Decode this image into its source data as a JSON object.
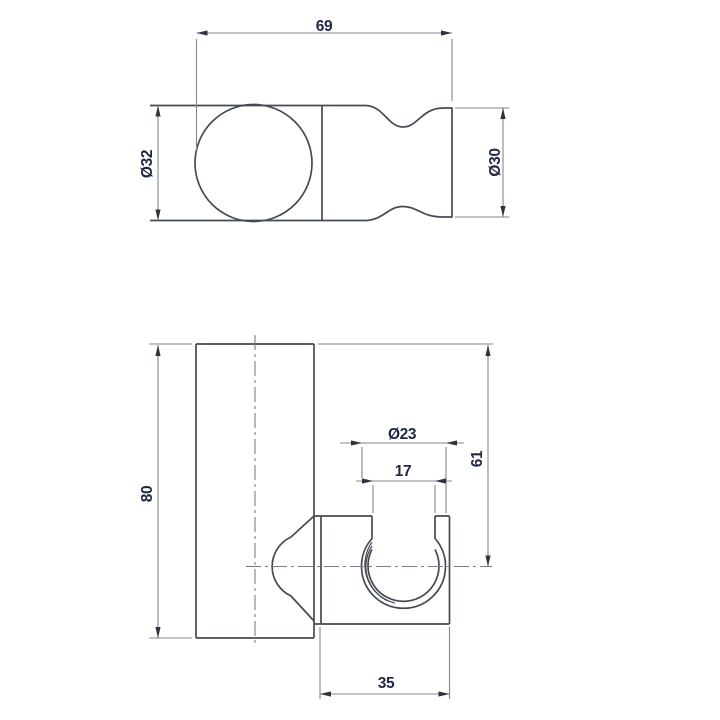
{
  "drawing": {
    "title": "shower-handset-wall-holder-technical-drawing",
    "colors": {
      "background": "#ffffff",
      "outline": "#454b55",
      "dimension_lines": "#82878f",
      "arrowheads": "#2e333d",
      "dimension_text": "#1e2744"
    },
    "views": {
      "top": {
        "labels": {
          "width": "69",
          "ball_diameter": "Ø32",
          "end_diameter": "Ø30"
        }
      },
      "front": {
        "labels": {
          "height": "80",
          "hole_diameter": "Ø23",
          "opening_width": "17",
          "center_offset": "61",
          "bracket_width": "35"
        }
      }
    }
  }
}
